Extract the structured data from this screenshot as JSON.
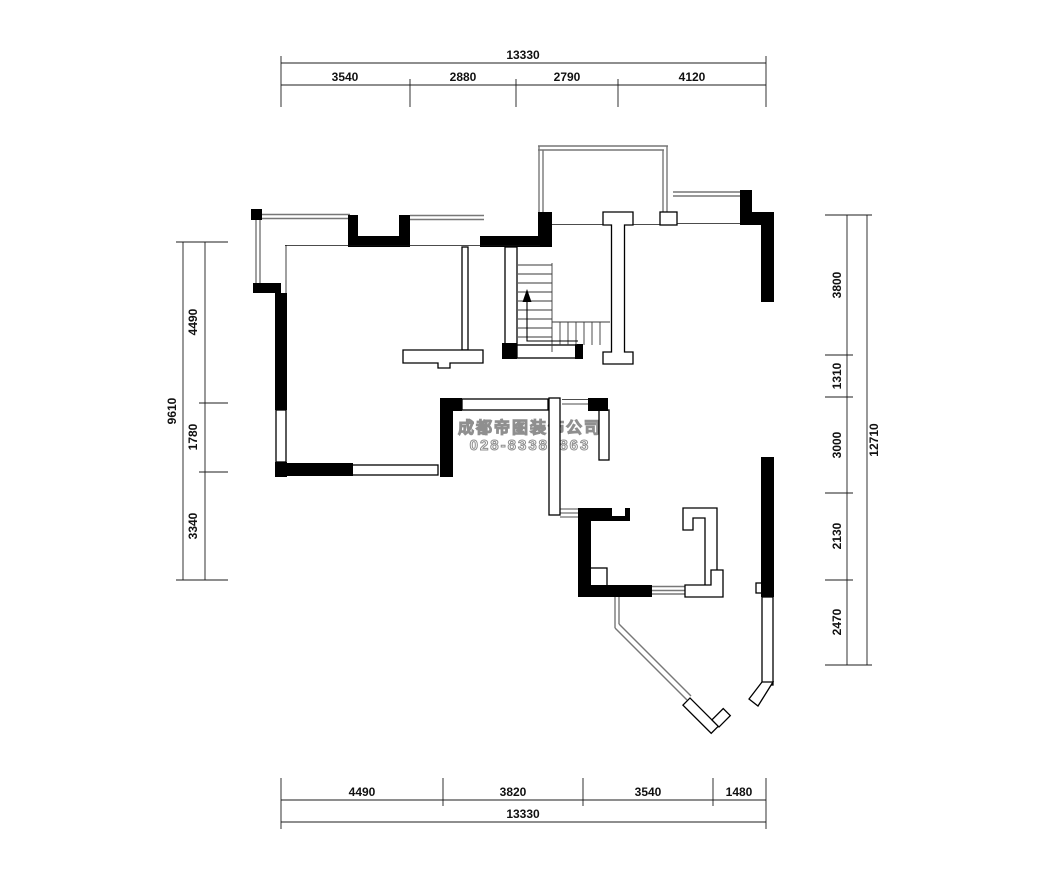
{
  "watermark": {
    "company_name": "成都帝图装饰公司",
    "phone": "028-83385863"
  },
  "dimensions": {
    "top": {
      "total": "13330",
      "segments": [
        "3540",
        "2880",
        "2790",
        "4120"
      ]
    },
    "bottom": {
      "total": "13330",
      "segments": [
        "4490",
        "3820",
        "3540",
        "1480"
      ]
    },
    "left": {
      "total": "9610",
      "segments": [
        "4490",
        "1780",
        "3340"
      ]
    },
    "right": {
      "total": "12710",
      "segments": [
        "3800",
        "1310",
        "3000",
        "2130",
        "2470"
      ]
    }
  },
  "stairs": {
    "direction_icon": "up-arrow"
  }
}
